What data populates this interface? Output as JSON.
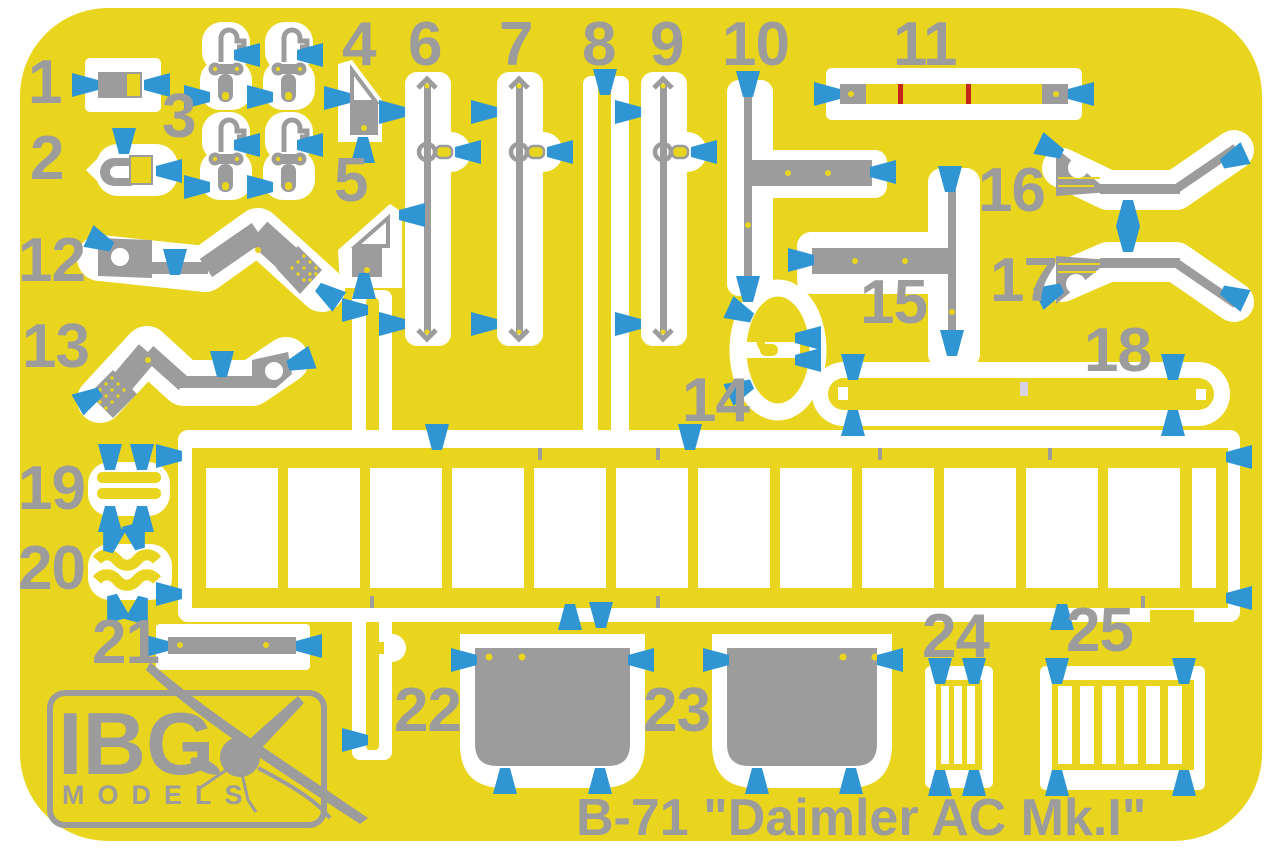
{
  "sheet": {
    "title": "B-71 \"Daimler AC Mk.I\""
  },
  "logo": {
    "brand": "IBG",
    "sub": "MODELS"
  },
  "colors": {
    "sheet_yellow": "#e9d41e",
    "part_gray": "#9c9c9c",
    "arrow_blue": "#2f96d3",
    "cutout_white": "#ffffff",
    "red_mark": "#c1251b"
  },
  "parts": [
    {
      "number": "1"
    },
    {
      "number": "2"
    },
    {
      "number": "3"
    },
    {
      "number": "4"
    },
    {
      "number": "5"
    },
    {
      "number": "6"
    },
    {
      "number": "7"
    },
    {
      "number": "8"
    },
    {
      "number": "9"
    },
    {
      "number": "10"
    },
    {
      "number": "11"
    },
    {
      "number": "12"
    },
    {
      "number": "13"
    },
    {
      "number": "14"
    },
    {
      "number": "15"
    },
    {
      "number": "16"
    },
    {
      "number": "17"
    },
    {
      "number": "18"
    },
    {
      "number": "19"
    },
    {
      "number": "20"
    },
    {
      "number": "21"
    },
    {
      "number": "22"
    },
    {
      "number": "23"
    },
    {
      "number": "24"
    },
    {
      "number": "25"
    }
  ]
}
